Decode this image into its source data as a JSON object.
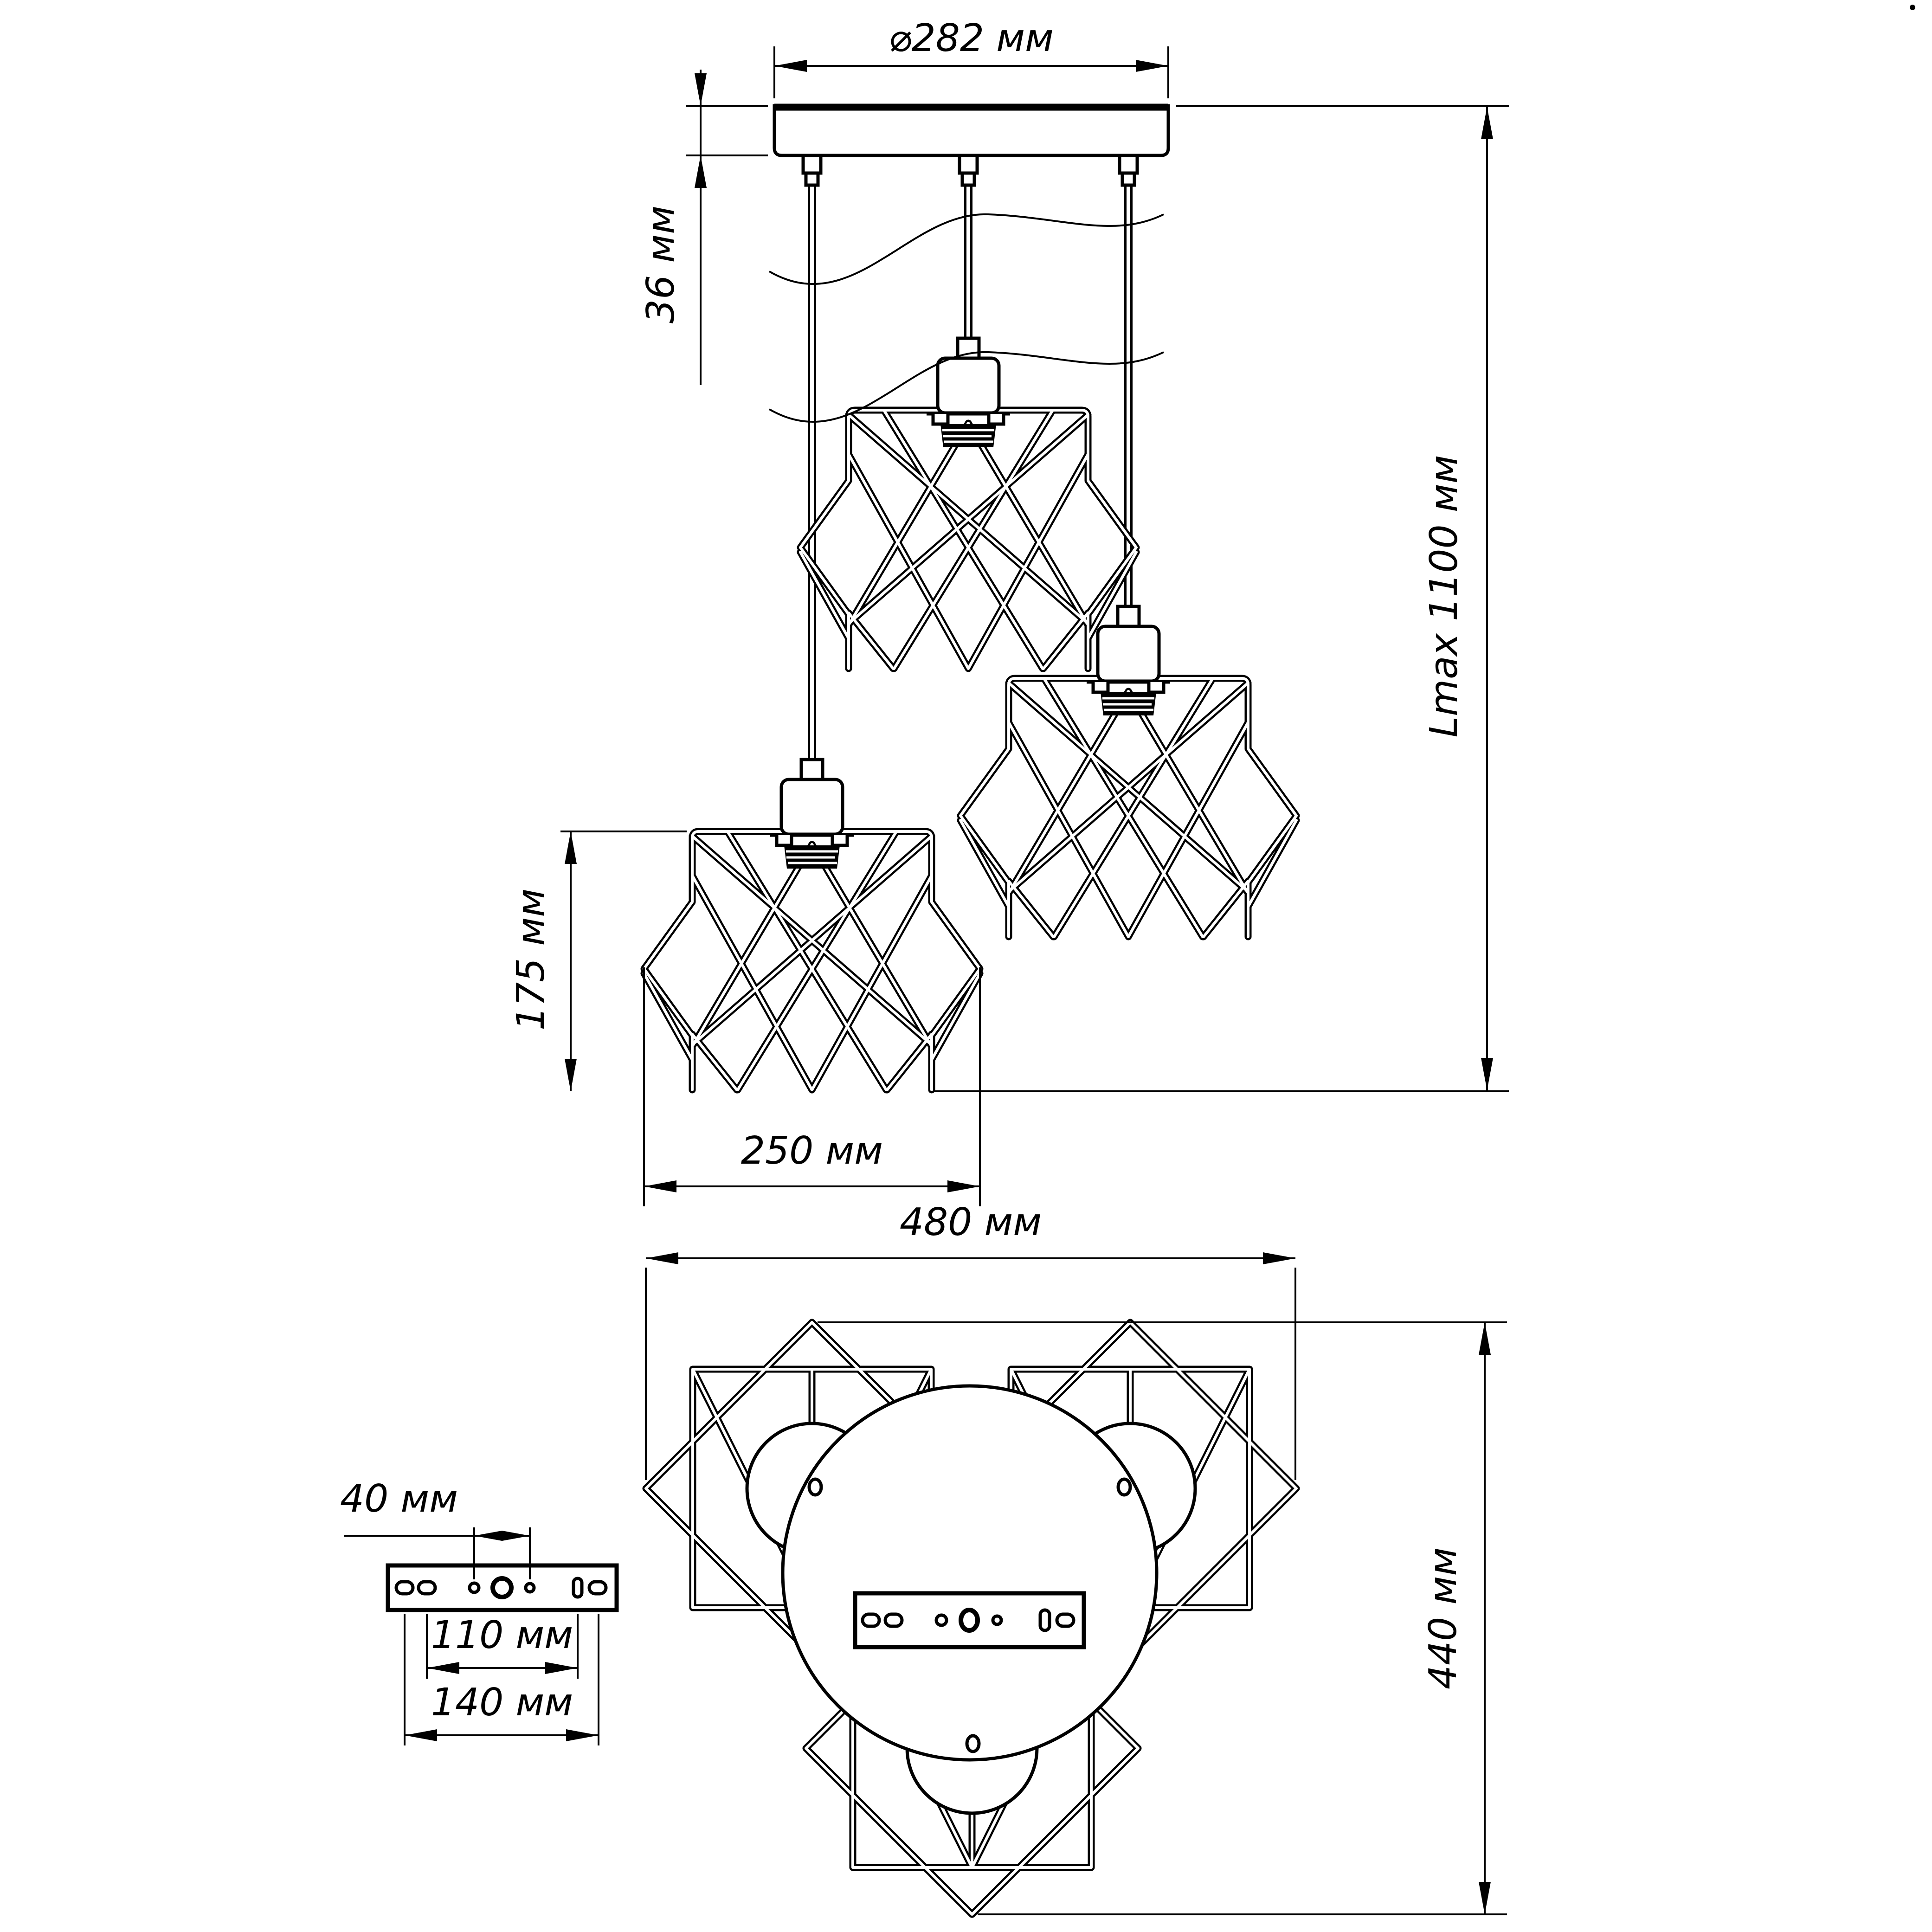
{
  "drawing": {
    "front_view": {
      "canopy_diameter_label": "⌀282 мм",
      "canopy_height_label": "36 мм",
      "max_length_label": "Lmax 1100 мм",
      "shade_height_label": "175 мм",
      "shade_width_label": "250 мм"
    },
    "plan_view": {
      "overall_width_label": "480 мм",
      "overall_depth_label": "440 мм"
    },
    "bracket_view": {
      "small_hole_spacing_label": "40 мм",
      "middle_hole_spacing_label": "110 мм",
      "outer_hole_spacing_label": "140 мм"
    },
    "colors": {
      "ink": "#000000",
      "paper": "#ffffff"
    }
  }
}
